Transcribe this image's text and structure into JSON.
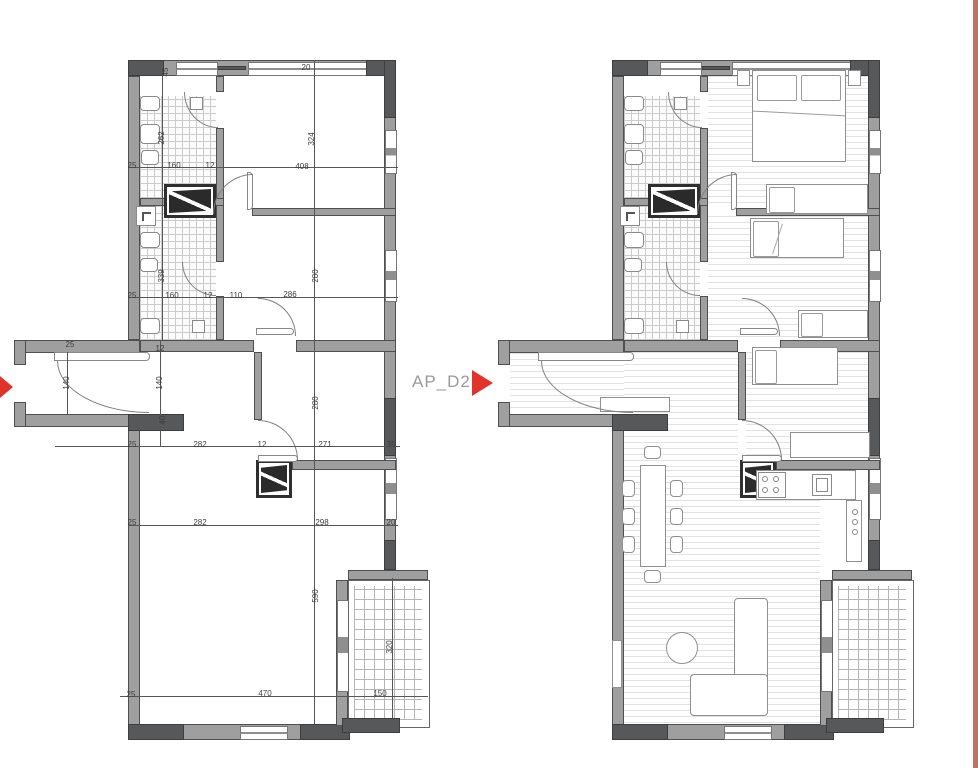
{
  "title": "Apartment floor plan AP_D23 — dimensioned and furnished plans",
  "label": {
    "text": "AP_D23"
  },
  "colors": {
    "bg": "#ffffff",
    "accent": "#e2332b",
    "label_gray": "#9a9a9a",
    "wall_gray": "#9f9f9f",
    "wall_dark": "#57585a",
    "line": "#4f4f4f",
    "edge_bar": "#bd7268"
  },
  "plans": {
    "left": {
      "name": "dimensioned plan",
      "dimensions": [
        {
          "t": "45",
          "x": 166,
          "y": 72,
          "v": true
        },
        {
          "t": "20",
          "x": 306,
          "y": 68,
          "v": false
        },
        {
          "t": "324",
          "x": 312,
          "y": 139,
          "v": true
        },
        {
          "t": "262",
          "x": 162,
          "y": 138,
          "v": true
        },
        {
          "t": "25",
          "x": 132,
          "y": 166,
          "v": false
        },
        {
          "t": "160",
          "x": 174,
          "y": 166,
          "v": false
        },
        {
          "t": "12",
          "x": 210,
          "y": 166,
          "v": false
        },
        {
          "t": "408",
          "x": 302,
          "y": 167,
          "v": false
        },
        {
          "t": "339",
          "x": 162,
          "y": 276,
          "v": true
        },
        {
          "t": "25",
          "x": 132,
          "y": 296,
          "v": false
        },
        {
          "t": "160",
          "x": 172,
          "y": 296,
          "v": false
        },
        {
          "t": "12",
          "x": 208,
          "y": 296,
          "v": false
        },
        {
          "t": "110",
          "x": 236,
          "y": 296,
          "v": false
        },
        {
          "t": "286",
          "x": 290,
          "y": 295,
          "v": false
        },
        {
          "t": "280",
          "x": 316,
          "y": 276,
          "v": true
        },
        {
          "t": "25",
          "x": 70,
          "y": 345,
          "v": false
        },
        {
          "t": "12",
          "x": 160,
          "y": 349,
          "v": false
        },
        {
          "t": "140",
          "x": 67,
          "y": 383,
          "v": true
        },
        {
          "t": "140",
          "x": 160,
          "y": 383,
          "v": true
        },
        {
          "t": "40",
          "x": 163,
          "y": 420,
          "v": true
        },
        {
          "t": "25",
          "x": 132,
          "y": 445,
          "v": false
        },
        {
          "t": "282",
          "x": 200,
          "y": 445,
          "v": false
        },
        {
          "t": "12",
          "x": 262,
          "y": 445,
          "v": false
        },
        {
          "t": "271",
          "x": 325,
          "y": 445,
          "v": false
        },
        {
          "t": "35",
          "x": 391,
          "y": 445,
          "v": false
        },
        {
          "t": "280",
          "x": 316,
          "y": 403,
          "v": true
        },
        {
          "t": "25",
          "x": 132,
          "y": 523,
          "v": false
        },
        {
          "t": "282",
          "x": 200,
          "y": 523,
          "v": false
        },
        {
          "t": "298",
          "x": 322,
          "y": 523,
          "v": false
        },
        {
          "t": "20",
          "x": 391,
          "y": 523,
          "v": false
        },
        {
          "t": "590",
          "x": 316,
          "y": 596,
          "v": true
        },
        {
          "t": "320",
          "x": 390,
          "y": 647,
          "v": true
        },
        {
          "t": "25",
          "x": 131,
          "y": 695,
          "v": false
        },
        {
          "t": "470",
          "x": 265,
          "y": 694,
          "v": false
        },
        {
          "t": "150",
          "x": 380,
          "y": 694,
          "v": false
        }
      ]
    },
    "right": {
      "name": "furnished plan",
      "dimensions": []
    }
  }
}
